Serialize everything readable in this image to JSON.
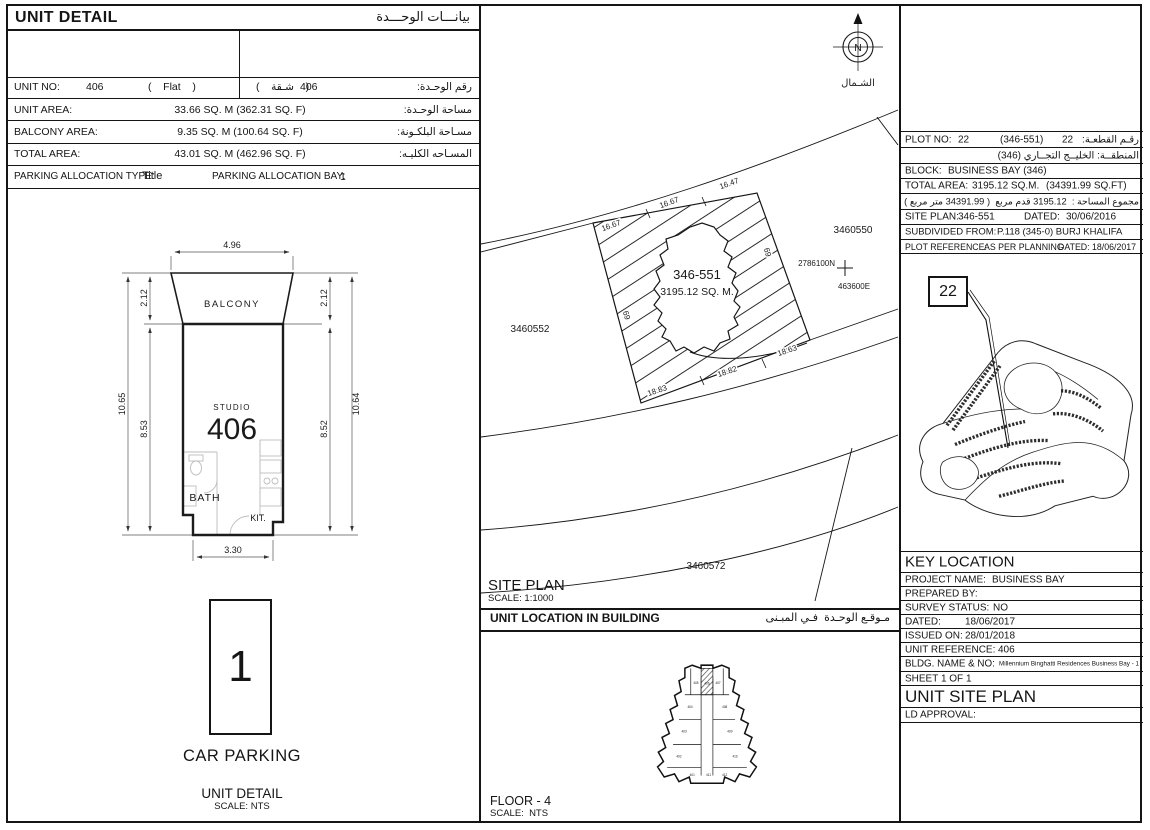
{
  "left": {
    "header_en": "UNIT DETAIL",
    "header_ar": "بيانـــات الوحـــدة",
    "unit_no_label": "UNIT NO:",
    "unit_no_value": "406",
    "unit_type": "(    Flat    )",
    "unit_type_ar": "(    شـقة    )",
    "unit_no_value_ar": "406",
    "unit_no_label_ar": "رقم الوحـدة:",
    "unit_area_label": "UNIT AREA:",
    "unit_area_value": "33.66 SQ. M (362.31 SQ. F)",
    "unit_area_label_ar": "مساحة الوحـدة:",
    "balcony_label": "BALCONY AREA:",
    "balcony_value": "9.35 SQ. M (100.64 SQ. F)",
    "balcony_label_ar": "مسـاحة البلكـونة:",
    "total_label": "TOTAL AREA:",
    "total_value": "43.01 SQ. M (462.96 SQ. F)",
    "total_label_ar": "المسـاحه الكليـه:",
    "parking_type_label": "PARKING ALLOCATION TYPE:",
    "parking_type_value": "Title",
    "parking_bay_label": "PARKING ALLOCATION BAY:",
    "parking_bay_value": "1"
  },
  "floor_plan": {
    "balcony": "BALCONY",
    "studio": "STUDIO",
    "unit_number": "406",
    "bath": "BATH",
    "kitchen": "KIT.",
    "dim_top": "4.96",
    "dim_bottom": "3.30",
    "dim_left_outer": "10.65",
    "dim_left_upper": "2.12",
    "dim_left_lower": "8.53",
    "dim_right_outer": "10.64",
    "dim_right_upper": "2.12",
    "dim_right_lower": "8.52"
  },
  "car_parking": {
    "bay_number": "1",
    "title": "CAR PARKING",
    "caption": "UNIT DETAIL",
    "scale": "SCALE: NTS"
  },
  "site_plan": {
    "north_letter": "N",
    "north_ar": "الشـمال",
    "plot_id": "346-551",
    "plot_area": "3195.12 SQ. M.",
    "neighbor_plots": [
      "3460550",
      "3460552",
      "3460572"
    ],
    "coord_north": "2786100N",
    "coord_east": "463600E",
    "dims_top": [
      "16.67",
      "16.67",
      "16.47"
    ],
    "dim_side_left": "69",
    "dim_side_right": "69",
    "dims_bottom": [
      "18.83",
      "18.82",
      "18.63"
    ],
    "title": "SITE PLAN",
    "scale": "SCALE: 1:1000"
  },
  "unit_location": {
    "header_en": "UNIT LOCATION IN BUILDING",
    "header_ar": "مـوقـع الوحـدة  فـي المبـنى",
    "floor": "FLOOR - 4",
    "scale": "SCALE:  NTS",
    "units": [
      "405",
      "406",
      "407",
      "404",
      "408",
      "403",
      "409",
      "402",
      "410",
      "401",
      "411",
      "412"
    ]
  },
  "plot_info": {
    "plot_no_label": "PLOT NO:",
    "plot_no_value": "22",
    "plot_no_ref": "(346-551)",
    "plot_no_value_ar": "22",
    "plot_no_label_ar": "رقـم القطعـة:",
    "district_ar": "المنطقــة: الخليــج التجــاري (346)",
    "block_label": "BLOCK:",
    "block_value": "BUSINESS BAY (346)",
    "total_area_label": "TOTAL AREA:",
    "total_area_sqm": "3195.12 SQ.M.",
    "total_area_sqft": "(34391.99 SQ.FT)",
    "total_area_ar": "مجموع المساحة :  3195.12 قدم مربع  ( 34391.99 متر مربع )",
    "site_plan_label": "SITE PLAN:",
    "site_plan_value": "346-551",
    "dated_label": "DATED:",
    "dated_value": "30/06/2016",
    "subdivided_label": "SUBDIVIDED FROM:",
    "subdivided_value": "P.118 (345-0) BURJ KHALIFA",
    "plot_ref_label": "PLOT REFERENCE:",
    "plot_ref_value": "AS PER PLANNING",
    "plot_ref_dated_label": "DATED:",
    "plot_ref_dated_value": "18/06/2017",
    "key_marker": "22"
  },
  "key_location": {
    "title": "KEY LOCATION",
    "project_label": "PROJECT NAME:",
    "project_value": "BUSINESS BAY",
    "prepared_label": "PREPARED BY:",
    "survey_label": "SURVEY STATUS:",
    "survey_value": "NO",
    "dated_label": "DATED:",
    "dated_value": "18/06/2017",
    "issued_label": "ISSUED ON:",
    "issued_value": "28/01/2018",
    "unit_ref_label": "UNIT REFERENCE:",
    "unit_ref_value": "406",
    "bldg_label": "BLDG. NAME & NO:",
    "bldg_value": "Millennium Binghatti Residences Business Bay - 1",
    "sheet_label": "SHEET 1 OF 1",
    "doc_title": "UNIT SITE PLAN",
    "ld_approval_label": "LD APPROVAL:"
  }
}
